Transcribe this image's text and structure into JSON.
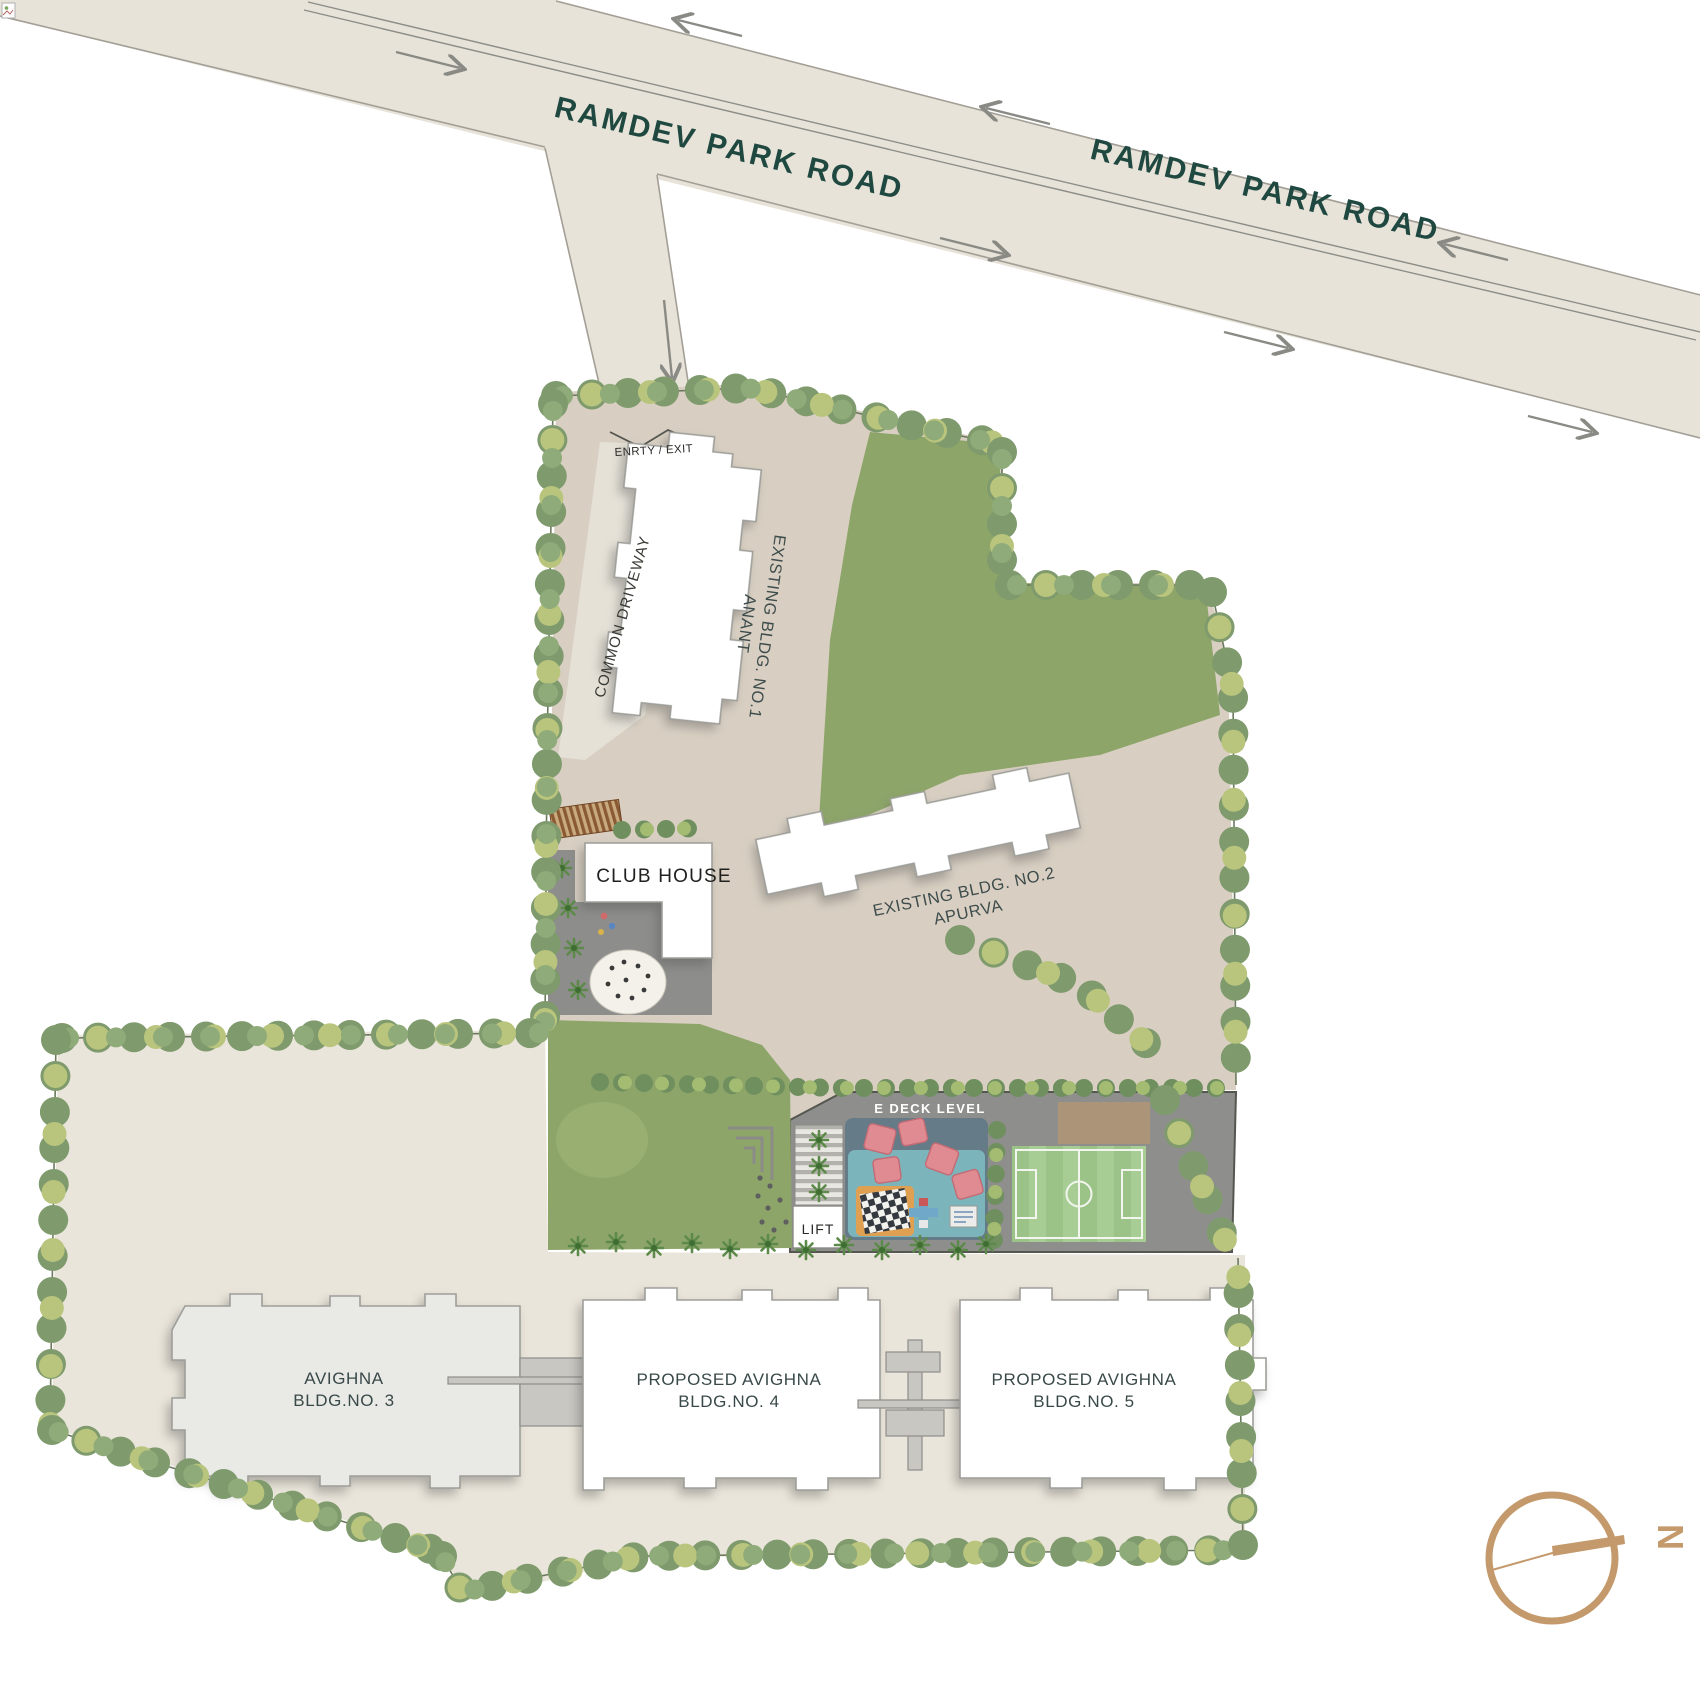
{
  "title": "Avighna site plan at Ramdev Park Road",
  "roads": {
    "label_west": "RAMDEV PARK ROAD",
    "label_east": "RAMDEV PARK ROAD"
  },
  "access": {
    "entry_exit_label": "ENRTY / EXIT",
    "driveway_label": "COMMON DRIVEWAY",
    "lift_label": "LIFT"
  },
  "buildings": {
    "existing_1": {
      "line1": "EXISTING BLDG. NO.1",
      "line2": "ANANT"
    },
    "existing_2": {
      "line1": "EXISTING BLDG. NO.2",
      "line2": "APURVA"
    },
    "club_house": {
      "label": "CLUB HOUSE"
    },
    "bldg_3": {
      "line1": "AVIGHNA",
      "line2": "BLDG.NO. 3"
    },
    "bldg_4": {
      "line1": "PROPOSED AVIGHNA",
      "line2": "BLDG.NO. 4"
    },
    "bldg_5": {
      "line1": "PROPOSED AVIGHNA",
      "line2": "BLDG.NO. 5"
    }
  },
  "amenities": {
    "deck_label": "E DECK LEVEL"
  },
  "compass": {
    "north_label": "N"
  },
  "colors": {
    "road_fill": "#e7e3d9",
    "road_text": "#1f4840",
    "upper_parcel": "#d8cfc2",
    "lower_parcel": "#eae5da",
    "lawn_green": "#8da569",
    "deck_gray": "#8e8f8d",
    "pitch_green": "#9bc287",
    "playground_pad": "#7cb4bc",
    "canopy_red": "#e08b92",
    "mat_orange": "#dfa052",
    "bridge_brown": "#8a5a33",
    "compass_bronze": "#c49a6c",
    "tree_dark": "#7f9a6d",
    "tree_light": "#b9c57d"
  }
}
